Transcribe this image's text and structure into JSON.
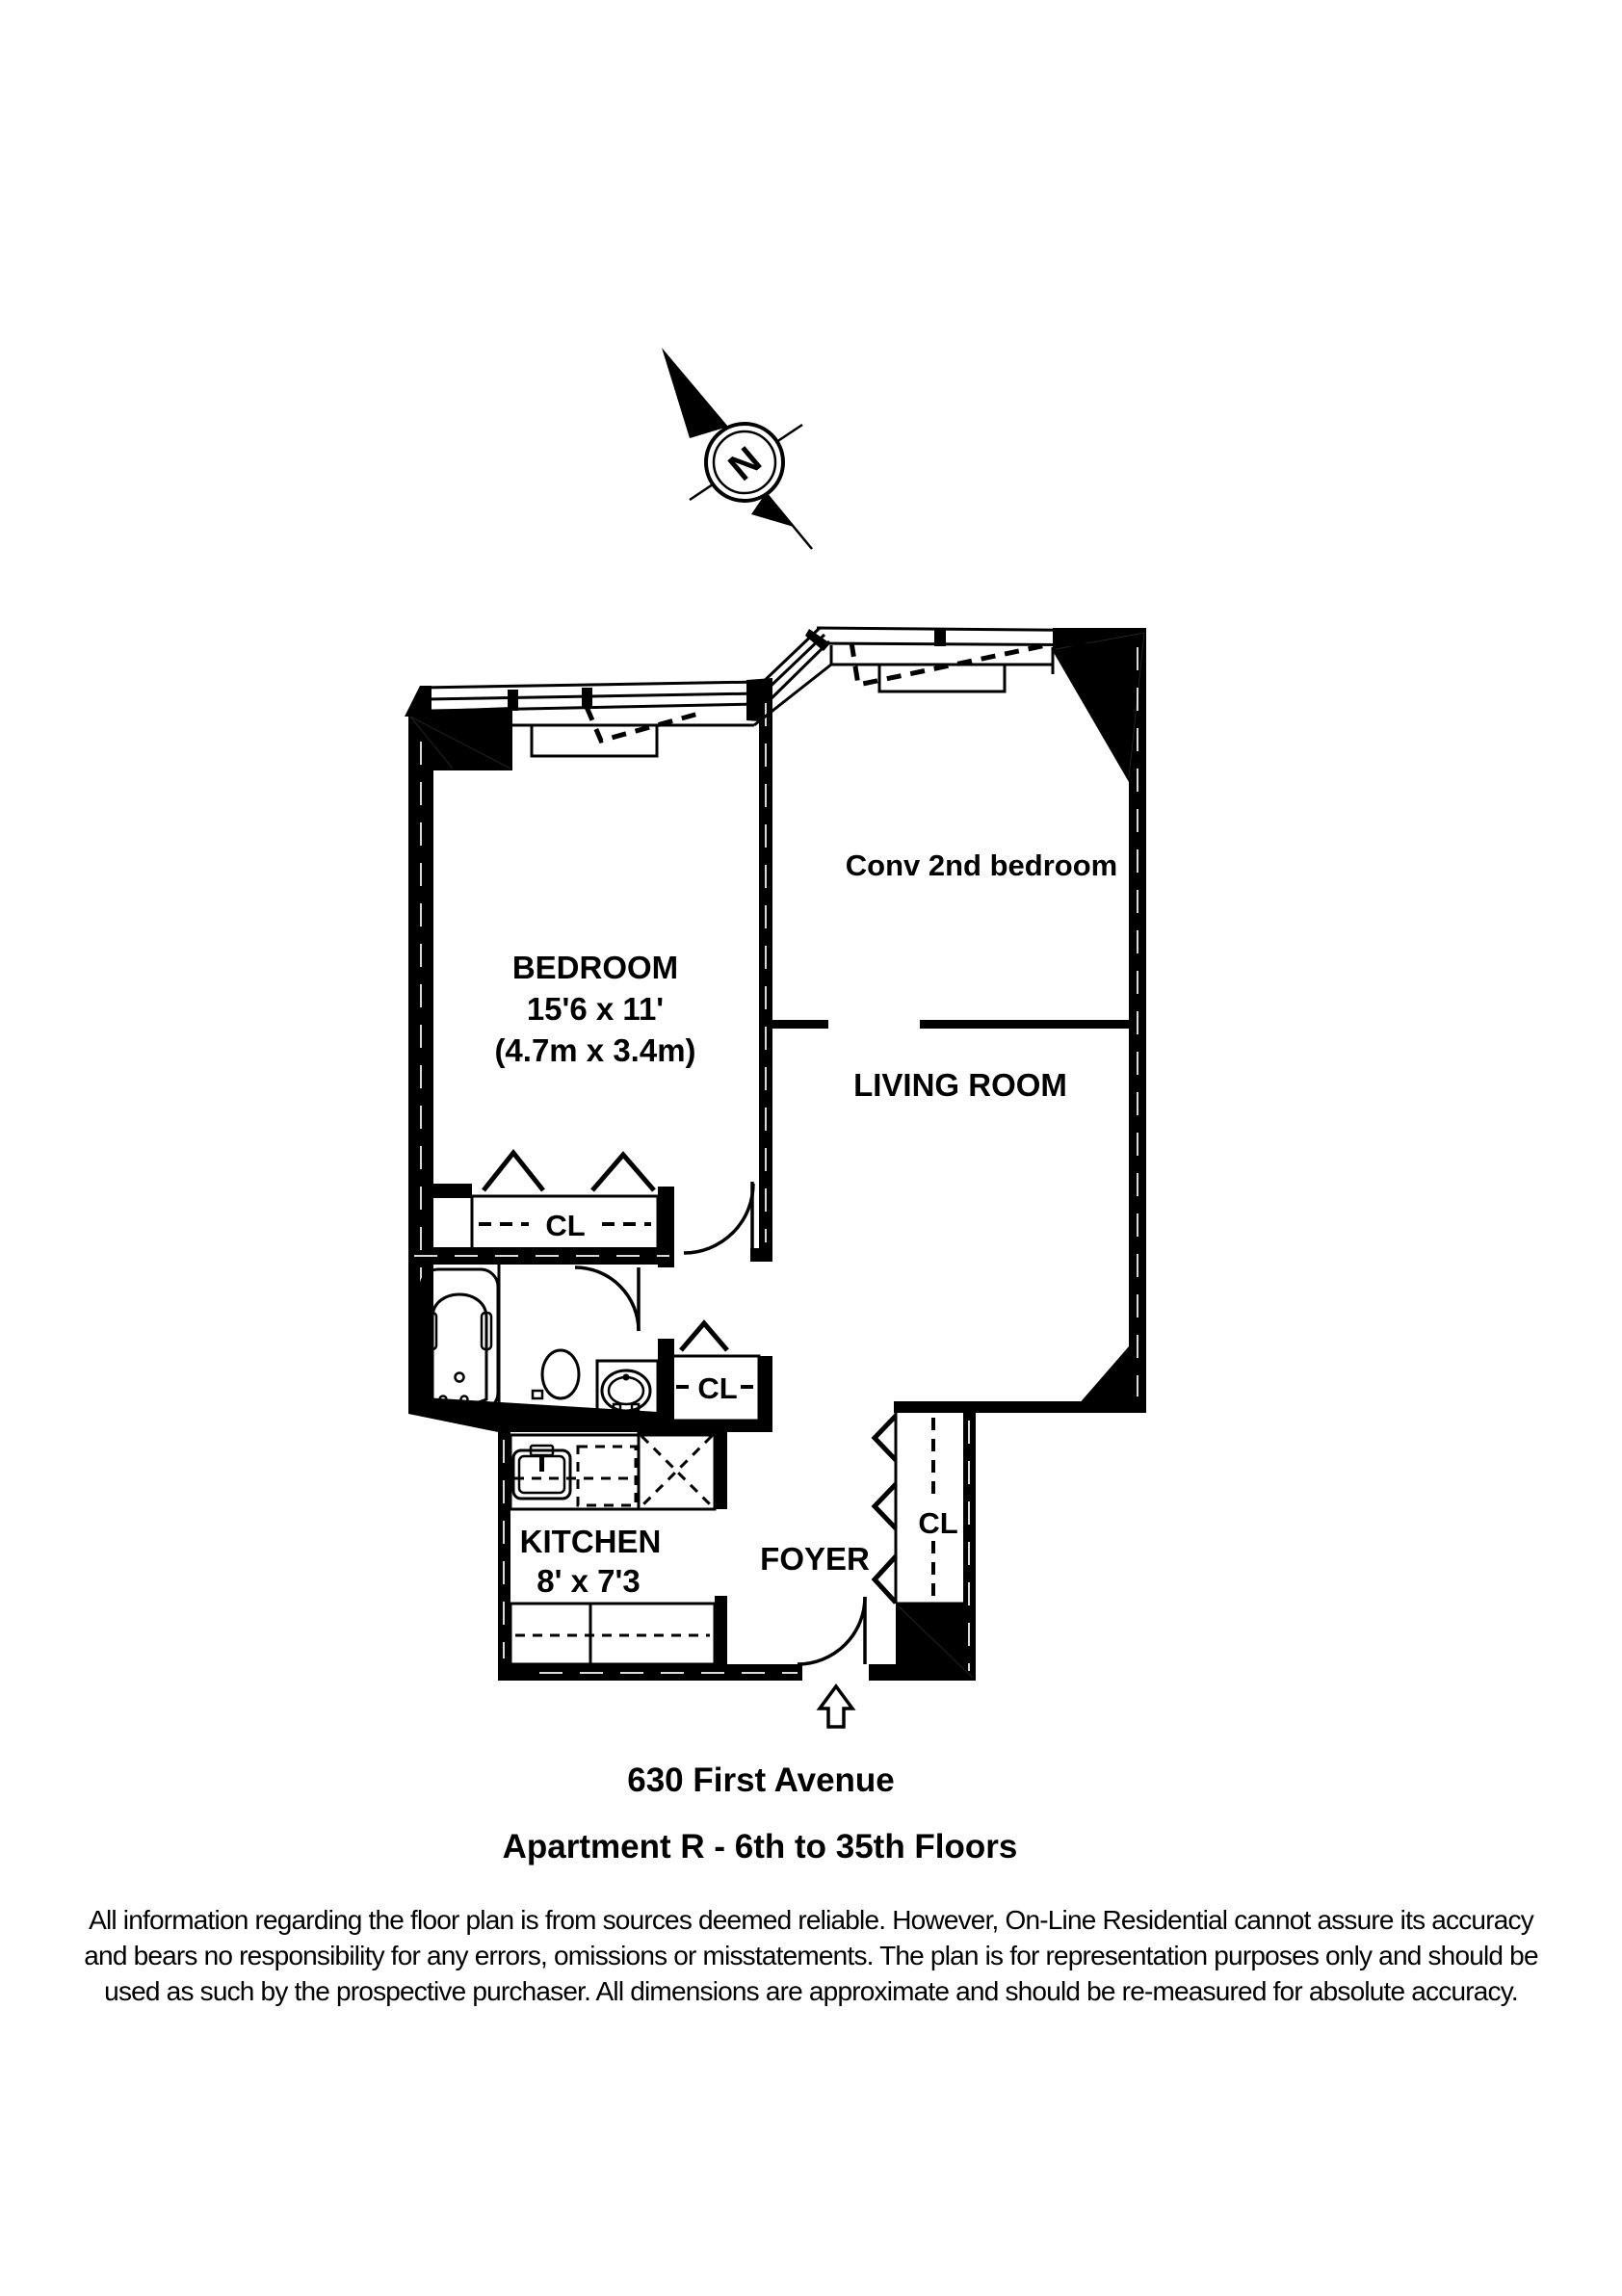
{
  "colors": {
    "ink": "#000000",
    "paper": "#ffffff"
  },
  "compass": {
    "north_label": "N"
  },
  "rooms": {
    "bedroom": {
      "name": "BEDROOM",
      "dims_ft": "15'6 x 11'",
      "dims_m": "(4.7m x 3.4m)"
    },
    "conv_bedroom": {
      "name": "Conv 2nd bedroom"
    },
    "living_room": {
      "name": "LIVING ROOM"
    },
    "kitchen": {
      "name": "KITCHEN",
      "dims_ft": "8' x 7'3"
    },
    "foyer": {
      "name": "FOYER"
    },
    "closet_bedroom": {
      "label": "CL"
    },
    "closet_hall": {
      "label": "CL"
    },
    "closet_foyer": {
      "label": "CL"
    }
  },
  "footer": {
    "address": "630 First Avenue",
    "apartment_line": "Apartment R - 6th to 35th Floors",
    "disclaimer": [
      "All information regarding the floor plan is from sources deemed reliable.  However, On-Line Residential cannot assure its accuracy",
      "and bears no responsibility for any errors, omissions or misstatements.  The plan is for representation purposes only and should be",
      "used as such by the prospective purchaser.  All dimensions are approximate and should be re-measured for absolute accuracy."
    ]
  }
}
